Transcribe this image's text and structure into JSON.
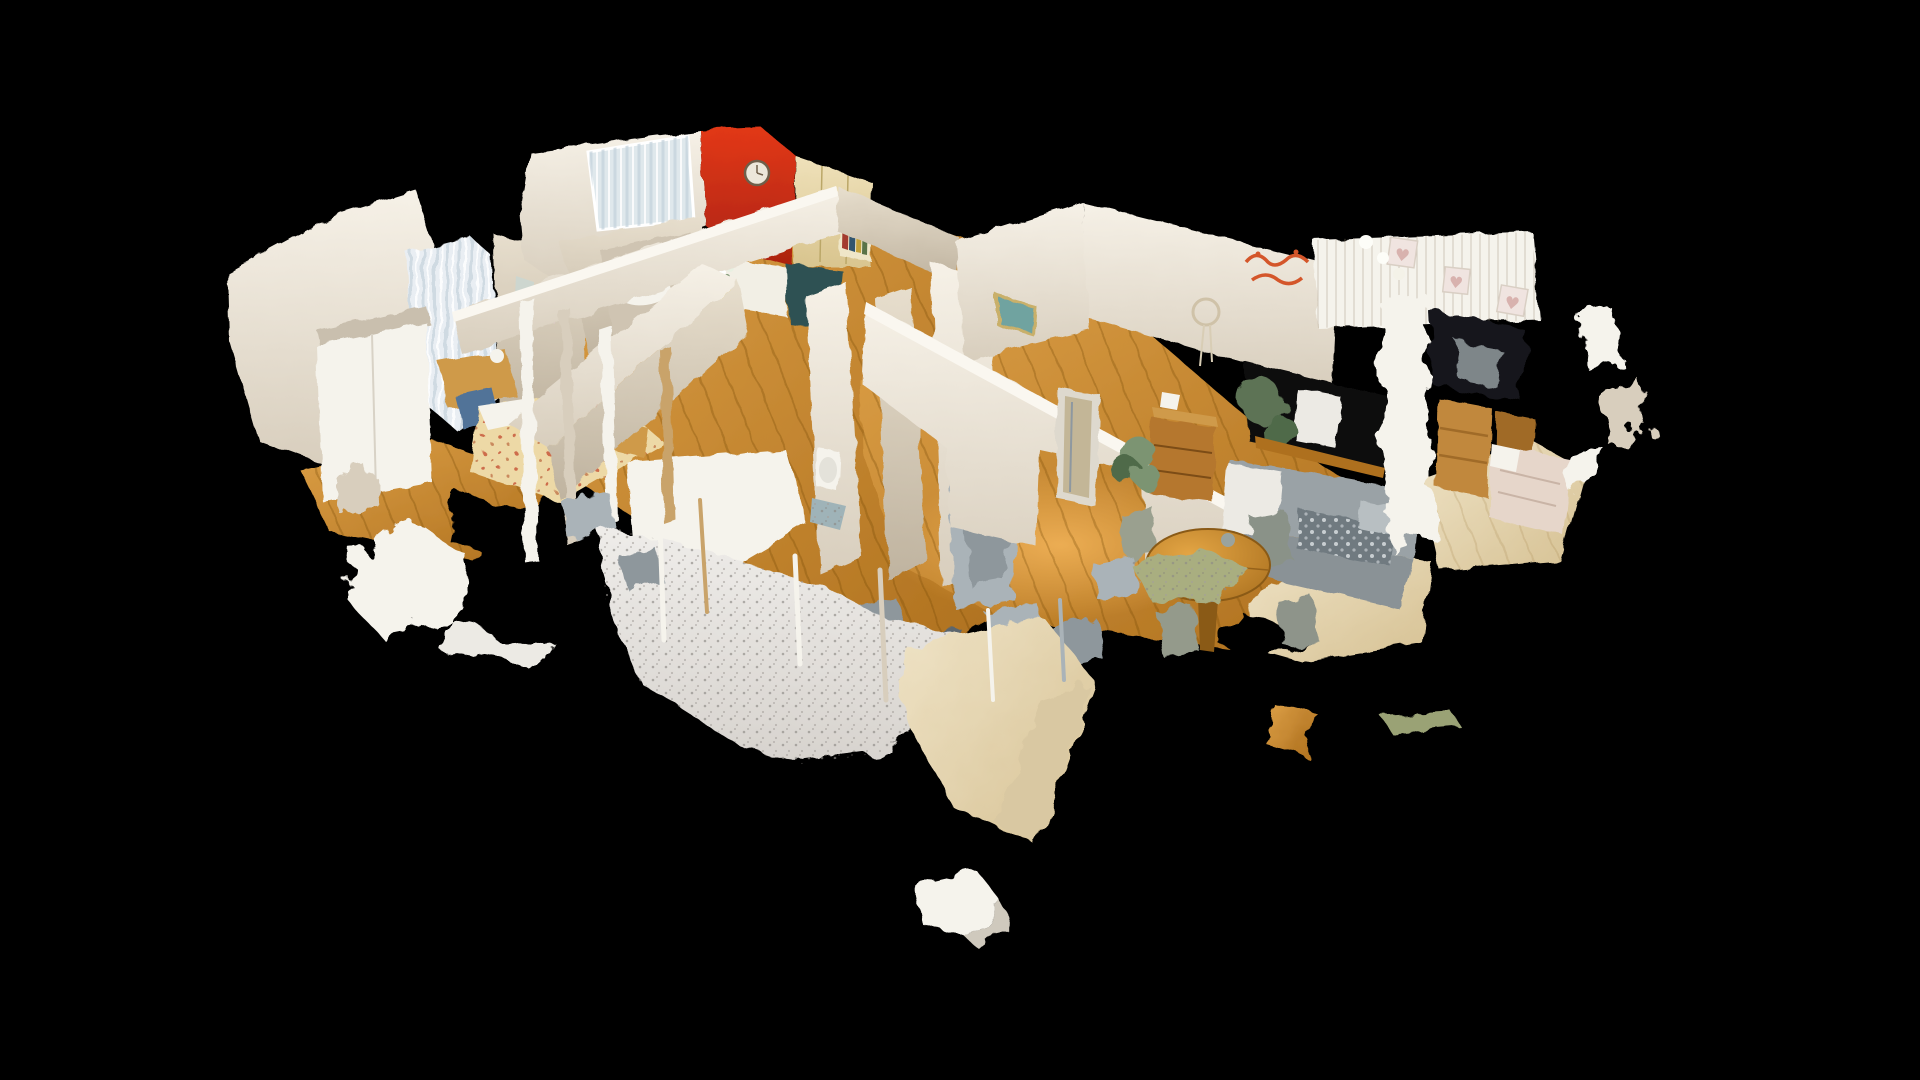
{
  "scene": {
    "type": "3d-dollhouse-scan-view",
    "description": "Overhead dollhouse view of a photogrammetry-scanned apartment floating on a black void, with ragged scan-hole artifacts",
    "rooms": [
      {
        "id": "bedroom-left",
        "label": "bedroom with white wardrobe, sheer curtains, floral bed, vanity desk and blue chair"
      },
      {
        "id": "kitchen",
        "label": "kitchen with red accent wall, wall clock, window, cream cabinets, bookshelf and teal cabinet"
      },
      {
        "id": "bathroom",
        "label": "bathroom with toilet, mosaic tile floor and mirror door"
      },
      {
        "id": "hallway",
        "label": "hallway with oak flooring and ragged partition walls"
      },
      {
        "id": "living-room",
        "label": "living room with flamingo wall art, dream catcher, piano nook, grey sofa, round dining table"
      },
      {
        "id": "bedroom-right",
        "label": "bedroom with beadboard wall, heart frames, pine dressers and bed"
      }
    ],
    "objects": [
      "wall-clock",
      "window-curtains",
      "bookshelf",
      "kitchen-counter",
      "teal-cabinet",
      "flower-vase",
      "toilet",
      "tiled-floor",
      "mirror-door",
      "wall-mirror-shards",
      "flamingo-wall-art",
      "dream-catcher",
      "heart-wall-frames",
      "track-lights",
      "piano",
      "house-plants",
      "wooden-dresser",
      "table-lamp",
      "gray-sofa",
      "lace-throw",
      "round-dining-table",
      "dining-chairs",
      "area-rug",
      "floral-bed",
      "blue-chair",
      "vanity-desk",
      "wardrobe",
      "pine-dresser",
      "double-bed",
      "scan-fragments"
    ]
  },
  "glyphs": {
    "heart": "♥"
  },
  "colors": {
    "background": "#000000",
    "white": "#f5f3ec",
    "wallTop": "#f6f1e7",
    "wallBottom": "#d8cebd",
    "wallShadeTop": "#e7decd",
    "wallShadeBottom": "#bfb39f",
    "wallLip": "#faf7f0",
    "redTop": "#e23818",
    "redBottom": "#ab2310",
    "clockFace": "#ece7da",
    "clockRing": "#6f5f4a",
    "cabinetTop": "#efe1ba",
    "cabinetBottom": "#d9c58f",
    "teal": "#2d5153",
    "counter": "#f2efe5",
    "woodTop": "#dc9f46",
    "woodBottom": "#ae701e",
    "woodHot": "#f3b459",
    "paleTop": "#efe3c6",
    "paleBottom": "#d6c193",
    "paleShade": "#d9c8a2",
    "rugTop": "#efedea",
    "rugBottom": "#d7d3ce",
    "rugSpeckle": "#8e8a86",
    "curtain": "#e9eef3",
    "glass": "#dfe8ec",
    "bedFloral": "#edd9a6",
    "bedDot": "#c2452a",
    "chairBlue": "#517398",
    "furnWood": "#b5772f",
    "furnWoodLight": "#cf9a4a",
    "pineWood": "#c1883e",
    "pineWoodDark": "#a06b28",
    "sofa": "#9aa2a6",
    "sofaSeat": "#8a9296",
    "sofaDark": "#6f7a80",
    "lace": "#eceae4",
    "plant": "#7b9472",
    "plantDark": "#4f6b4a",
    "plantDeep": "#5d7355",
    "pianoBlack": "#0b0b0b",
    "shardLight": "#aab3b8",
    "shardMid": "#8e979c",
    "shardDark": "#5b666d",
    "mirror": "#c3b697",
    "tile": "#9fb3b8",
    "sage": "#a9ae80",
    "heartFrame": "#f0e4e0",
    "heartFill": "#d8b2ae",
    "artTeal": "#6fa3a0",
    "artFrame": "#c9b06a",
    "flamingo": "#d4562a",
    "bedPink": "#e6d6ca",
    "bedPinkFold": "#c9b4a6",
    "tableTop": "#e3a544",
    "tableEdge": "#a96f1e",
    "pedestal": "#8a5a16",
    "vase": "#d8b93c",
    "doorGap": "#15151a",
    "seam": "#d8d2c6",
    "postTan": "#c9a36a"
  }
}
